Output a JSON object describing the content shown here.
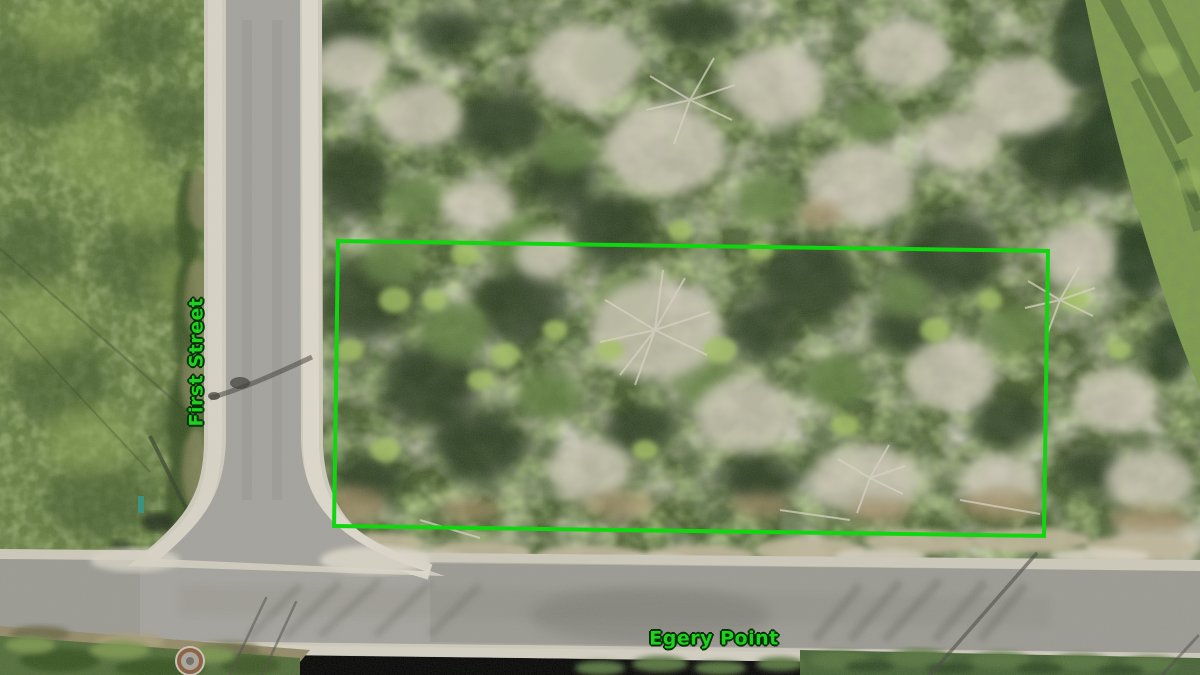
{
  "image_description": "Aerial drone photo of a vacant brush-covered lot outlined in green at the corner of First Street and Egery Point",
  "annotations": {
    "street_labels": [
      {
        "text": "First Street",
        "orientation": "vertical"
      },
      {
        "text": "Egery Point",
        "orientation": "horizontal"
      }
    ],
    "label_color": "#1dd11d",
    "property_boundary": {
      "shape": "rectangle",
      "stroke_color": "#10d610"
    }
  }
}
